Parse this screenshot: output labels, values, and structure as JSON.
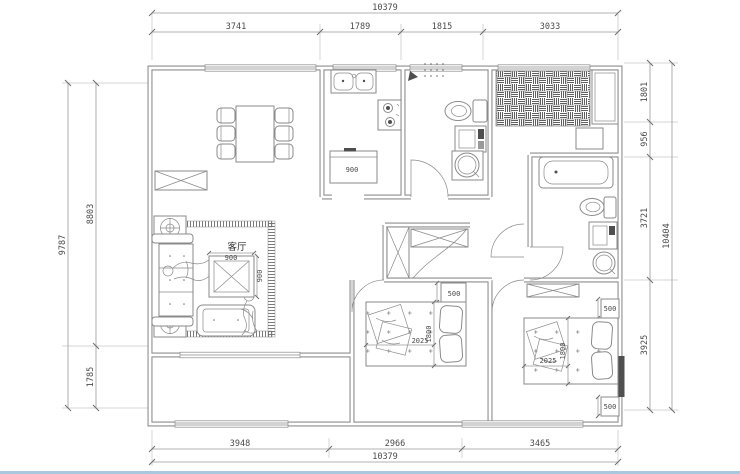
{
  "drawing": {
    "type": "apartment-floor-plan",
    "dimensions": {
      "top": {
        "total": "10379",
        "segments": [
          "3741",
          "1789",
          "1815",
          "3033"
        ]
      },
      "bottom": {
        "total": "10379",
        "segments": [
          "3948",
          "2966",
          "3465"
        ]
      },
      "left": {
        "total": "9787",
        "segments": [
          "8803",
          "1785"
        ]
      },
      "right": {
        "total": "10404",
        "segments": [
          "1801",
          "956",
          "3721",
          "3925"
        ]
      }
    },
    "rooms": {
      "living": {
        "label": "客厅",
        "coffee_table_width": "900",
        "coffee_table_depth": "900"
      },
      "kitchen": {
        "unit_width": "900"
      },
      "bedroom1": {
        "bed_width": "1800",
        "bed_length": "2025",
        "nightstand": "500"
      },
      "bedroom2": {
        "bed_width": "1800",
        "bed_length": "2025",
        "nightstand_top": "500",
        "nightstand_bottom": "500"
      }
    },
    "colors": {
      "background": "#ffffff",
      "wall": "#8e8e8e",
      "furniture_line": "#8a8a8a",
      "dimension_text": "#4a4a4a",
      "bottom_edge_strip": "#a9c7df"
    }
  }
}
